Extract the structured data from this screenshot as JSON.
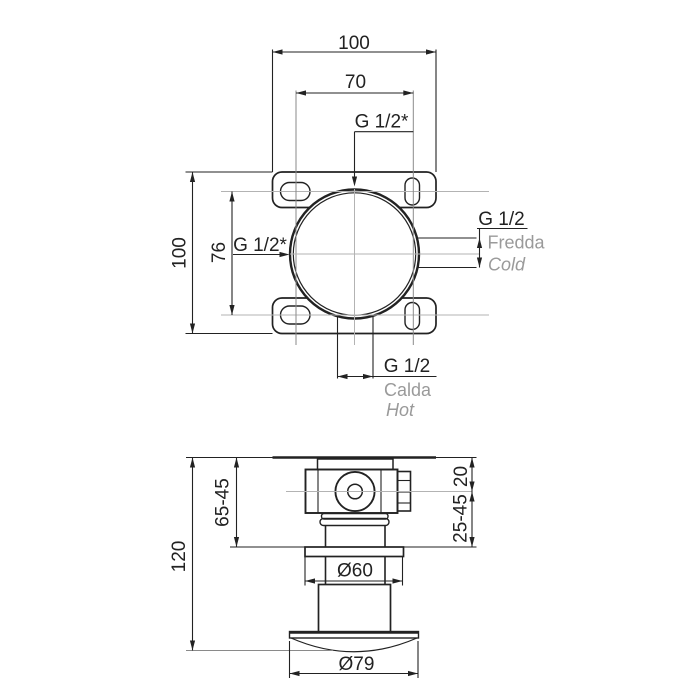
{
  "drawing": {
    "description": "Concealed shower mixer valve installation drawing, front rough-in view and side section view with dimensions in mm",
    "colors": {
      "line": "#222222",
      "centerline": "#b3b3b3",
      "muted_text": "#9a9a9a"
    },
    "top_view": {
      "dim_width": "100",
      "dim_port_spacing": "70",
      "dim_height": "100",
      "dim_slot_spacing": "76",
      "port_top": "G 1/2*",
      "port_left": "G 1/2*",
      "cold": {
        "thread": "G 1/2",
        "name_it": "Fredda",
        "name_en": "Cold"
      },
      "hot": {
        "thread": "G 1/2",
        "name_it": "Calda",
        "name_en": "Hot"
      }
    },
    "side_view": {
      "dim_depth_total": "120",
      "dim_depth_adjust": "65-45",
      "dim_plate_to_axis": "20",
      "dim_axis_to_flange": "25-45",
      "dim_flange_diameter": "Ø60",
      "dim_escutcheon_diameter": "Ø79"
    }
  }
}
